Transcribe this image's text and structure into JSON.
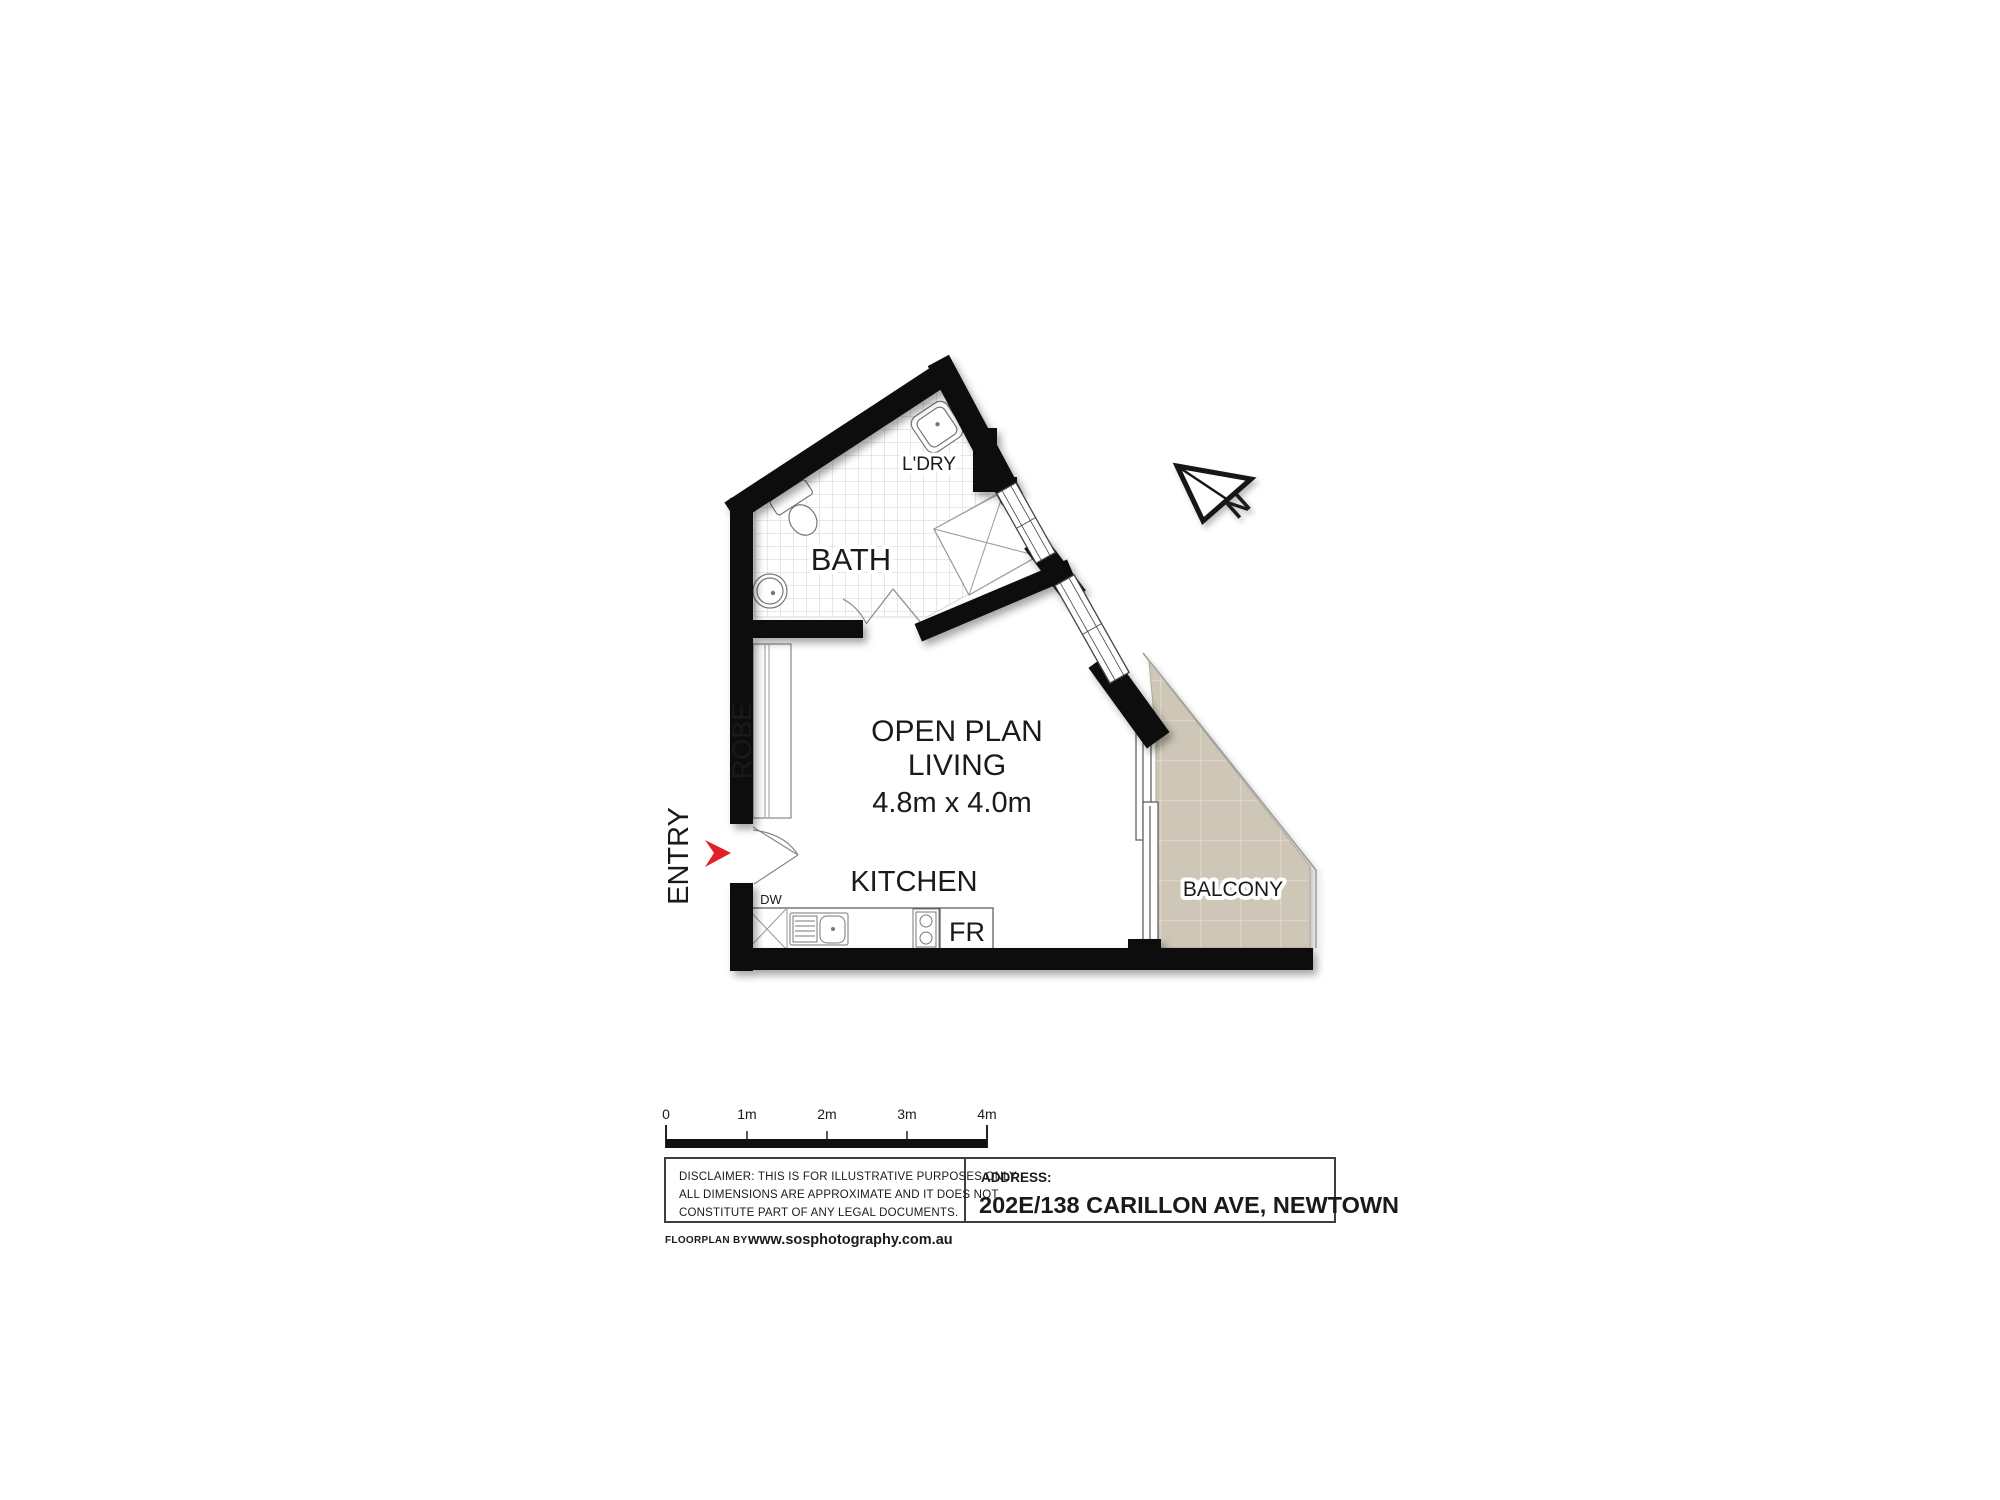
{
  "plan": {
    "rooms": {
      "bath": "BATH",
      "laundry": "L'DRY",
      "robe": "ROBE",
      "entry": "ENTRY",
      "kitchen": "KITCHEN",
      "living_line1": "OPEN PLAN",
      "living_line2": "LIVING",
      "living_dims": "4.8m x 4.0m",
      "balcony": "BALCONY"
    },
    "appliances": {
      "dishwasher": "DW",
      "fridge": "FR"
    },
    "compass_n": "N"
  },
  "scale_bar": {
    "labels": [
      "0",
      "1m",
      "2m",
      "3m",
      "4m"
    ]
  },
  "footer": {
    "disclaimer_line1": "DISCLAIMER: THIS IS FOR ILLUSTRATIVE PURPOSES ONLY.",
    "disclaimer_line2": "ALL DIMENSIONS ARE APPROXIMATE AND IT DOES NOT",
    "disclaimer_line3": "CONSTITUTE PART OF ANY LEGAL DOCUMENTS.",
    "address_label": "ADDRESS:",
    "address_value": "202E/138 CARILLON AVE, NEWTOWN",
    "credit_prefix": "FLOORPLAN BY",
    "credit_site": "www.sosphotography.com.au"
  },
  "colors": {
    "wall": "#111111",
    "tile_line": "#cfcfcf",
    "balcony_tile": "#cec6b6",
    "balcony_tile_joint": "#ddd6c8",
    "entry_arrow_red": "#e32028",
    "fixture_line": "#888888"
  }
}
